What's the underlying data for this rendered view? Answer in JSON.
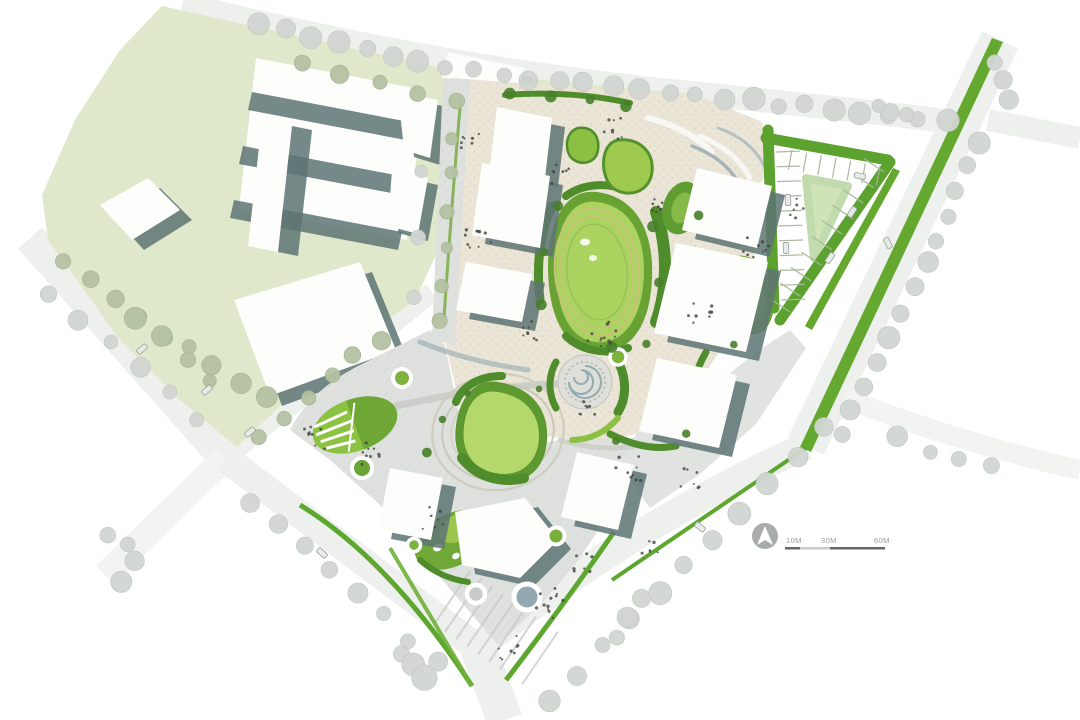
{
  "plan": {
    "type": "landscape-masterplan-site-plan",
    "scale_bar": {
      "labels": [
        "10M",
        "30M",
        "60M"
      ]
    },
    "north_arrow": {
      "icon": "north-arrow-icon"
    }
  },
  "colors": {
    "background": "#ffffff",
    "road": "#eef0ee",
    "roadFaint": "#f3f4f2",
    "contextGreen": "#dfe8ca",
    "buildingWhite": "#fdfdfc",
    "shadowSlate": "#5e7474",
    "plazaBeige": "#eae5d6",
    "plazaGray": "#dfe1de",
    "lawnBright": "#abd35f",
    "lawnMid": "#8cc043",
    "greenDark": "#4f8c2b",
    "hedgeGreen": "#5ca22e",
    "medianGreen": "#64a82f",
    "trackRing": "#c9c07b",
    "ringGreen": "#9cc05a",
    "walkGray": "#c9ccc6",
    "waterSlate": "#93a8b0",
    "treeGray": "#d2d6d2",
    "treeGreen": "#b5c2a3",
    "treeDark": "#47802a",
    "stallLine": "#aab7a0",
    "stripeGray": "#c6c9c5",
    "personDot": "#3f443f",
    "carBody": "#e8eae8",
    "carEdge": "#99a29a",
    "scaleText": "#9b9b9b",
    "barDark": "#666666",
    "barLight": "#c9c9c9",
    "northCircle": "#a8acac",
    "northArrow": "#ffffff"
  }
}
